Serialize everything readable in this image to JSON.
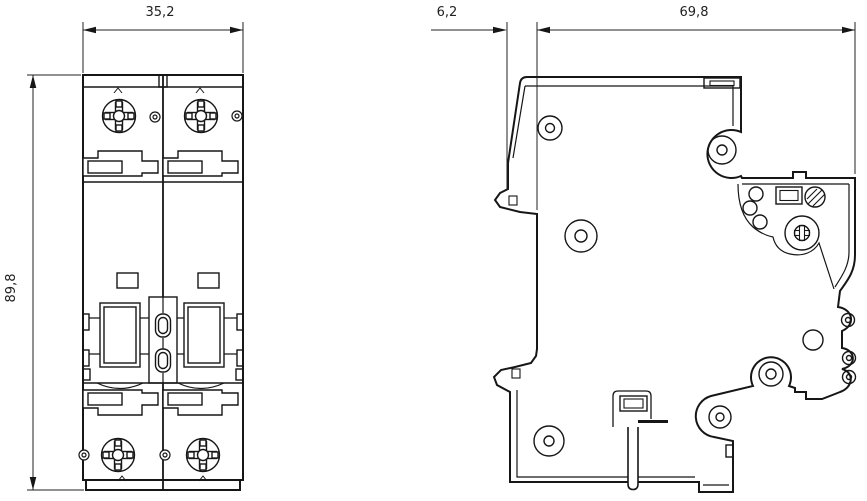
{
  "dimensions": {
    "front_width": "35,2",
    "front_height": "89,8",
    "side_clip_depth": "6,2",
    "side_overall_depth": "69,8"
  }
}
